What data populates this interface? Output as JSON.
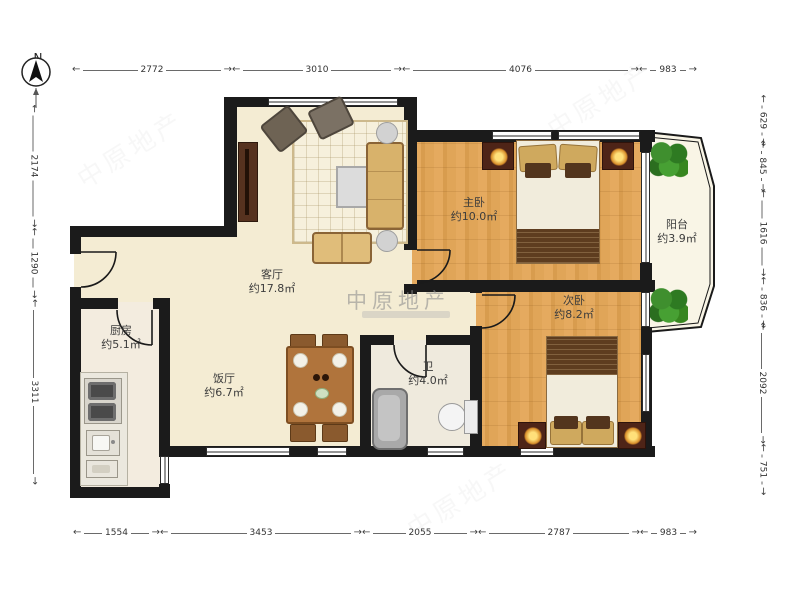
{
  "compass": {
    "label": "N"
  },
  "watermark": {
    "brand": "中原地产"
  },
  "rooms": {
    "living": {
      "name": "客厅",
      "area": "约17.8㎡"
    },
    "dining": {
      "name": "饭厅",
      "area": "约6.7㎡"
    },
    "kitchen": {
      "name": "厨房",
      "area": "约5.1㎡"
    },
    "bathroom": {
      "name": "卫",
      "area": "约4.0㎡"
    },
    "master_bedroom": {
      "name": "主卧",
      "area": "约10.0㎡"
    },
    "second_bedroom": {
      "name": "次卧",
      "area": "约8.2㎡"
    },
    "balcony": {
      "name": "阳台",
      "area": "约3.9㎡"
    }
  },
  "dimensions": {
    "top": [
      "2772",
      "3010",
      "4076",
      "983"
    ],
    "bottom": [
      "1554",
      "3453",
      "2055",
      "2787",
      "983"
    ],
    "left": [
      "2174",
      "1290",
      "3311"
    ],
    "right": [
      "629",
      "845",
      "1616",
      "836",
      "2092",
      "751"
    ]
  }
}
